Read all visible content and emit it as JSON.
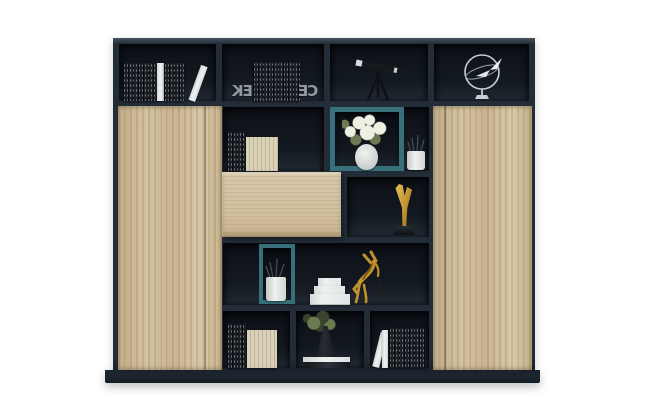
{
  "meta": {
    "description": "Product photo of a modern dark-navy office bookcase with light oak doors, a drawer front, teal display boxes and decorative shelf items on a white background",
    "background": "#ffffff"
  },
  "colors": {
    "bg": "#ffffff",
    "frame": "#232d38",
    "frame_top": "#46525e",
    "frame_dark": "#1a222b",
    "plinth": "#1d2630",
    "cell_top": "#0c1016",
    "cell_mid": "#141a21",
    "cell_floor": "#222a33",
    "wood": "#d2c0a0",
    "wood_dark": "#c1ac86",
    "wood_dark2": "#c9b490",
    "wood_light": "#d9c8a9",
    "teal": "#37707b",
    "gold": "#c0912f",
    "gold_light": "#ecc668",
    "gold_dark": "#6f4d0e",
    "dark_book": "#1c2026",
    "cream_book": "#d9d1b8",
    "cream_rib": "#bfb496",
    "white_book": "#eef0f1",
    "vase_white": "#f0f2f1",
    "flower_white": "#eef0e2",
    "leaf_green": "#6d7b52",
    "leaf_dark": "#39452a",
    "silver": "#a8aeb5"
  },
  "bookends": {
    "left": "EK",
    "right": "CE"
  },
  "items": {
    "cabinet": "bookcase cabinet",
    "plinth": "cabinet base plinth",
    "left_door": "left oak cabinet door",
    "right_door": "right oak cabinet door",
    "drawer": "oak drawer front",
    "top_books_left": "row of dark and white books",
    "top_books_center": "dark books with metal letter bookends",
    "telescope": "black telescope on tripod",
    "plane_ornament": "silver airplane orbit ornament",
    "flower_box": "teal display box with white flowers in vase",
    "pencil_cup": "white cup with pencils",
    "trophy": "gold angular trophy",
    "pencil_box": "teal display box with pencil cup",
    "white_book_stack": "stack of white books",
    "horse": "gold horse figurine",
    "shelf_books_mid": "dark and cream books",
    "bottom_books_left": "dark and cream books",
    "plant": "green plant in dark flask on books",
    "bottom_books_right": "white and dark books"
  }
}
